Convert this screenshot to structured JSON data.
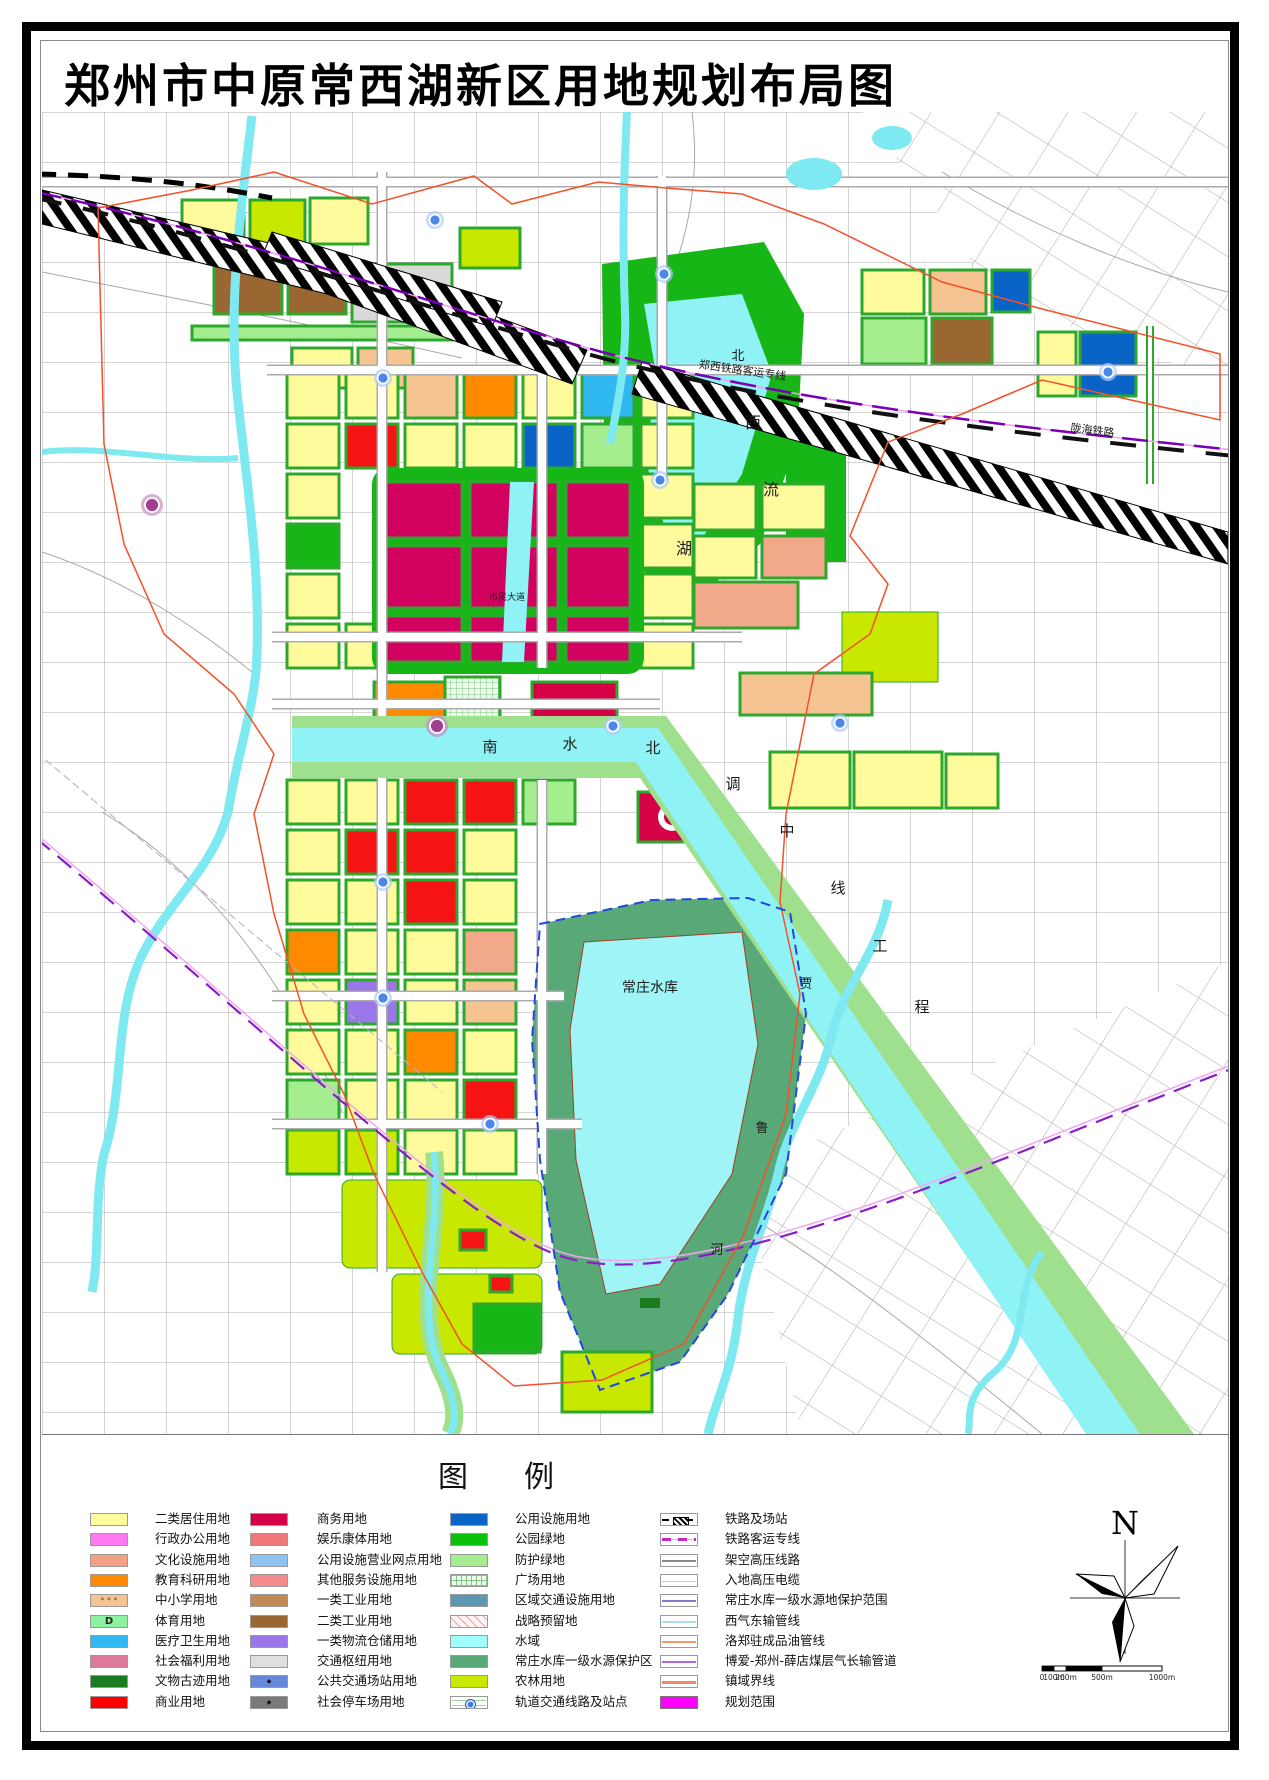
{
  "title": "郑州市中原常西湖新区用地规划布局图",
  "legend": {
    "header": "图例",
    "columns": [
      {
        "items": [
          {
            "label": "二类居住用地",
            "swatch": {
              "variant": "plain",
              "color": "#FFFB9D"
            }
          },
          {
            "label": "行政办公用地",
            "swatch": {
              "variant": "plain",
              "color": "#FF77F3"
            }
          },
          {
            "label": "文化设施用地",
            "swatch": {
              "variant": "plain",
              "color": "#F2A183"
            }
          },
          {
            "label": "教育科研用地",
            "swatch": {
              "variant": "plain",
              "color": "#FF8A00"
            }
          },
          {
            "label": "中小学用地",
            "swatch": {
              "variant": "dots",
              "color": "#F6C492"
            }
          },
          {
            "label": "体育用地",
            "swatch": {
              "variant": "letterD",
              "color": "#8CF2A0"
            }
          },
          {
            "label": "医疗卫生用地",
            "swatch": {
              "variant": "plain",
              "color": "#2FB9F0"
            }
          },
          {
            "label": "社会福利用地",
            "swatch": {
              "variant": "plain",
              "color": "#DD7A9B"
            }
          },
          {
            "label": "文物古迹用地",
            "swatch": {
              "variant": "plain",
              "color": "#1B7B21"
            }
          },
          {
            "label": "商业用地",
            "swatch": {
              "variant": "plain",
              "color": "#FF0000"
            }
          }
        ]
      },
      {
        "items": [
          {
            "label": "商务用地",
            "swatch": {
              "variant": "plain",
              "color": "#D50045"
            }
          },
          {
            "label": "娱乐康体用地",
            "swatch": {
              "variant": "plain",
              "color": "#F07878"
            }
          },
          {
            "label": "公用设施营业网点用地",
            "swatch": {
              "variant": "plain",
              "color": "#8FC3F2"
            }
          },
          {
            "label": "其他服务设施用地",
            "swatch": {
              "variant": "plain",
              "color": "#F48C8C"
            }
          },
          {
            "label": "一类工业用地",
            "swatch": {
              "variant": "plain",
              "color": "#C08A52"
            }
          },
          {
            "label": "二类工业用地",
            "swatch": {
              "variant": "plain",
              "color": "#9A6733"
            }
          },
          {
            "label": "一类物流仓储用地",
            "swatch": {
              "variant": "plain",
              "color": "#9B76E8"
            }
          },
          {
            "label": "交通枢纽用地",
            "swatch": {
              "variant": "plain",
              "color": "#DFDFDF"
            }
          },
          {
            "label": "公共交通场站用地",
            "swatch": {
              "variant": "mark",
              "color": "#6787DB"
            }
          },
          {
            "label": "社会停车场用地",
            "swatch": {
              "variant": "mark",
              "color": "#7A7A7A"
            }
          }
        ]
      },
      {
        "items": [
          {
            "label": "公用设施用地",
            "swatch": {
              "variant": "plain",
              "color": "#0A64C8"
            }
          },
          {
            "label": "公园绿地",
            "swatch": {
              "variant": "plain",
              "color": "#0BC20B"
            }
          },
          {
            "label": "防护绿地",
            "swatch": {
              "variant": "plain",
              "color": "#A5EE8F"
            }
          },
          {
            "label": "广场用地",
            "swatch": {
              "variant": "grid",
              "color": "#EFFBEF"
            }
          },
          {
            "label": "区域交通设施用地",
            "swatch": {
              "variant": "plain",
              "color": "#5C97B4"
            }
          },
          {
            "label": "战略预留地",
            "swatch": {
              "variant": "hatch",
              "color": "#FFF5F5"
            }
          },
          {
            "label": "水域",
            "swatch": {
              "variant": "plain",
              "color": "#9FFDFD"
            }
          },
          {
            "label": "常庄水库一级水源保护区",
            "swatch": {
              "variant": "plain",
              "color": "#58A878"
            }
          },
          {
            "label": "农林用地",
            "swatch": {
              "variant": "plain",
              "color": "#C8E800"
            }
          },
          {
            "label": "轨道交通线路及站点",
            "swatch": {
              "variant": "metro",
              "color": "#3D7BE8"
            }
          }
        ]
      },
      {
        "items": [
          {
            "label": "铁路及场站",
            "swatch": {
              "variant": "rail",
              "color": "#000000"
            }
          },
          {
            "label": "铁路客运专线",
            "swatch": {
              "variant": "rail2",
              "color": "#C726C7"
            }
          },
          {
            "label": "架空高压线路",
            "swatch": {
              "variant": "line",
              "color": "#8A8A8A"
            }
          },
          {
            "label": "入地高压电缆",
            "swatch": {
              "variant": "thinline",
              "color": "#CCCCCC"
            }
          },
          {
            "label": "常庄水库一级水源地保护范围",
            "swatch": {
              "variant": "line",
              "color": "#8877CC"
            }
          },
          {
            "label": "西气东输管线",
            "swatch": {
              "variant": "line",
              "color": "#AADDEE"
            }
          },
          {
            "label": "洛郑驻成品油管线",
            "swatch": {
              "variant": "line",
              "color": "#EE9966"
            }
          },
          {
            "label": "博爱-郑州-薛店煤层气长输管道",
            "swatch": {
              "variant": "line",
              "color": "#AA66EE"
            }
          },
          {
            "label": "镇域界线",
            "swatch": {
              "variant": "thickline",
              "color": "#EE8866"
            }
          },
          {
            "label": "规划范围",
            "swatch": {
              "variant": "solid",
              "color": "#FF00FF"
            }
          }
        ]
      }
    ]
  },
  "compass": {
    "north_label": "N"
  },
  "scale_bar": {
    "labels": [
      "0",
      "100m",
      "200m",
      "500m",
      "1000m"
    ]
  },
  "map": {
    "labels": [
      {
        "text": "北",
        "x": 696,
        "y": 248,
        "size": 13
      },
      {
        "text": "郑西铁路客运专线",
        "x": 700,
        "y": 262,
        "size": 11,
        "rotate": 8
      },
      {
        "text": "陇海铁路",
        "x": 1050,
        "y": 322,
        "size": 11,
        "rotate": 7
      },
      {
        "text": "西",
        "x": 711,
        "y": 316,
        "size": 16
      },
      {
        "text": "流",
        "x": 729,
        "y": 383,
        "size": 16
      },
      {
        "text": "湖",
        "x": 642,
        "y": 442,
        "size": 16
      },
      {
        "text": "南",
        "x": 448,
        "y": 640,
        "size": 15
      },
      {
        "text": "水",
        "x": 528,
        "y": 637,
        "size": 15
      },
      {
        "text": "北",
        "x": 611,
        "y": 641,
        "size": 15
      },
      {
        "text": "调",
        "x": 691,
        "y": 677,
        "size": 15
      },
      {
        "text": "中",
        "x": 745,
        "y": 724,
        "size": 15
      },
      {
        "text": "线",
        "x": 796,
        "y": 781,
        "size": 15
      },
      {
        "text": "工",
        "x": 838,
        "y": 839,
        "size": 15
      },
      {
        "text": "程",
        "x": 880,
        "y": 900,
        "size": 15
      },
      {
        "text": "常庄水库",
        "x": 608,
        "y": 880,
        "size": 14
      },
      {
        "text": "贾",
        "x": 764,
        "y": 876,
        "size": 13
      },
      {
        "text": "鲁",
        "x": 720,
        "y": 1020,
        "size": 13
      },
      {
        "text": "河",
        "x": 675,
        "y": 1142,
        "size": 13
      },
      {
        "text": "市民大道",
        "x": 465,
        "y": 488,
        "size": 9
      }
    ]
  }
}
